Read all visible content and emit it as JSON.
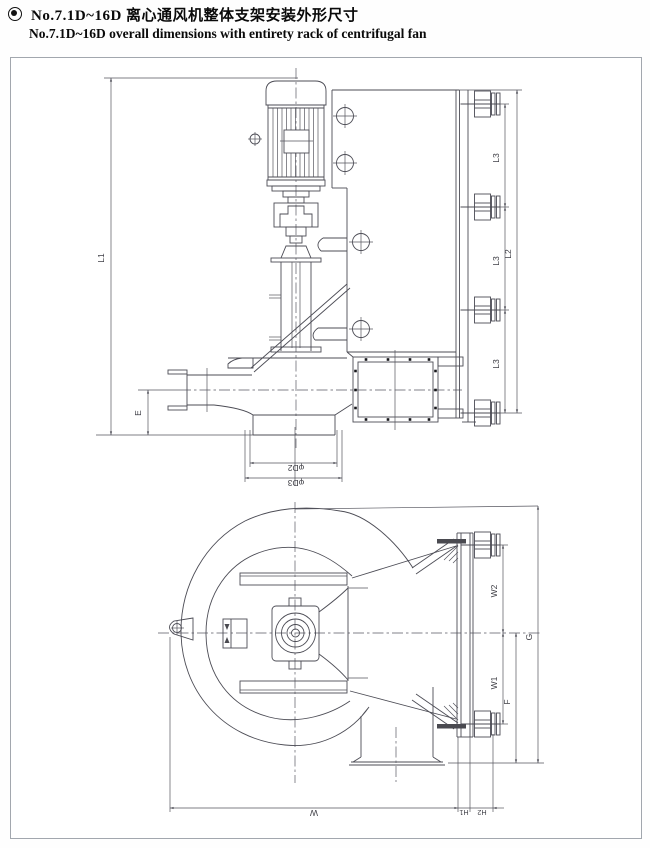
{
  "header": {
    "bullet_icon": "double-ring-bullet",
    "title_zh": "No.7.1D~16D 离心通风机整体支架安装外形尺寸",
    "title_en": "No.7.1D~16D overall dimensions with entirety rack  of centrifugal fan"
  },
  "drawing": {
    "description": "Two-view dimensional outline drawing of a centrifugal fan on a mounting rack",
    "line_color": "#4c4c55",
    "frame_color": "#a2a7ae",
    "side_view": {
      "dims": {
        "l1": "L1",
        "l2": "L2",
        "l3": "L3",
        "e": "E",
        "d2": "φD2",
        "d3": "φD3"
      }
    },
    "front_view": {
      "dims": {
        "w2": "W2",
        "w1": "W1",
        "f": "F",
        "g": "G",
        "w": "W",
        "h1": "H1",
        "h2": "H2"
      }
    }
  }
}
